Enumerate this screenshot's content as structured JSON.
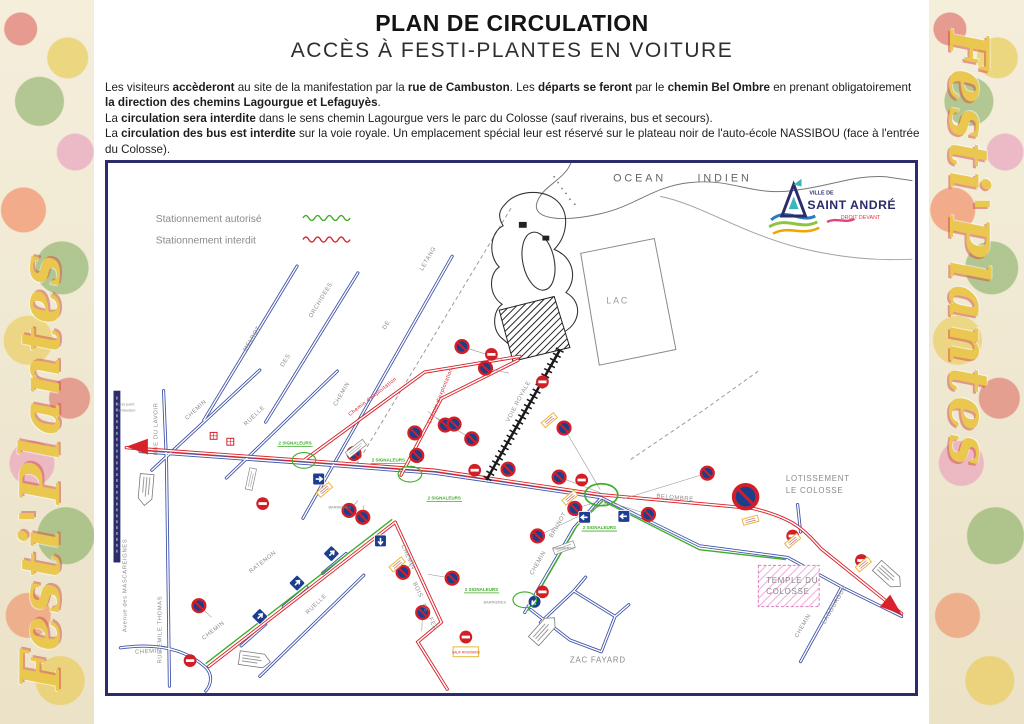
{
  "page": {
    "title_line1": "PLAN DE CIRCULATION",
    "title_line2": "ACCÈS À FESTI-PLANTES EN VOITURE",
    "side_text": "Festi'Plantes"
  },
  "intro": {
    "runs": [
      {
        "t": "Les visiteurs "
      },
      {
        "t": "accèderont",
        "b": 1
      },
      {
        "t": " au site de la manifestation par la "
      },
      {
        "t": "rue de Cambuston",
        "b": 1
      },
      {
        "t": ". Les "
      },
      {
        "t": "départs se feront",
        "b": 1
      },
      {
        "t": " par le "
      },
      {
        "t": "chemin Bel Ombre",
        "b": 1
      },
      {
        "t": " en prenant obligatoirement "
      },
      {
        "t": "la direction des chemins Lagourgue et Lefaguyès",
        "b": 1
      },
      {
        "t": "."
      },
      {
        "t": "La ",
        "br": 1
      },
      {
        "t": "circulation sera interdite",
        "b": 1
      },
      {
        "t": " dans le sens chemin Lagourgue vers le parc du Colosse (sauf riverains, bus et secours)."
      },
      {
        "t": "La ",
        "br": 1
      },
      {
        "t": "circulation des bus est interdite",
        "b": 1
      },
      {
        "t": " sur la voie royale. Un emplacement spécial leur est réservé sur le plateau noir de l'auto-école NASSIBOU (face à l'entrée du Colosse)."
      }
    ]
  },
  "legend": {
    "authorized": "Stationnement autorisé",
    "forbidden": "Stationnement interdit"
  },
  "logo": {
    "ville_de": "VILLE DE",
    "name": "SAINT ANDRÉ",
    "tagline": "DROIT DEVANT"
  },
  "map": {
    "places": {
      "ocean1": "OCEAN",
      "ocean2": "INDIEN",
      "lac": "LAC",
      "rond_point1": "Rond point",
      "rond_point2": "Cambuston",
      "lotissement1": "LOTISSEMENT",
      "lotissement2": "LE COLOSSE",
      "temple1": "TEMPLE DU",
      "temple2": "COLOSSE",
      "zac": "ZAC  FAYARD"
    },
    "streets": {
      "chemin": "CHEMIN",
      "ruelle": "RUELLE",
      "melrot": "MELROT",
      "des": "DES",
      "orchidees": "ORCHIDEES",
      "de": "DE",
      "letang": "LETANG",
      "rue_du_lavoir": "RUE  DU LAVOIR",
      "rue_emile_thomas": "RUE  EMILE  THOMAS",
      "mascareignes": "Avenue des MASCAREIGNES",
      "ratenon": "RATENON",
      "bois": "BOIS",
      "fer": "FER",
      "brunot": "BRUNOT",
      "belombre": "BELOMBRE",
      "lagourgue": "LAGOURGUE",
      "voie_royale": "VOIE   ROYALE",
      "exploitation": "Chemin d'exploitation"
    },
    "notes": {
      "signaleurs": "2 SIGNALEURS",
      "barrieres": "BARRIERES",
      "sauf_riverains": "SAUF RIVERAINS"
    },
    "signs": [
      {
        "type": "np",
        "x": 358,
        "y": 187
      },
      {
        "type": "np",
        "x": 382,
        "y": 209
      },
      {
        "type": "np",
        "x": 341,
        "y": 267
      },
      {
        "type": "np",
        "x": 310,
        "y": 275
      },
      {
        "type": "np",
        "x": 350,
        "y": 266
      },
      {
        "type": "np",
        "x": 368,
        "y": 281
      },
      {
        "type": "np",
        "x": 312,
        "y": 298
      },
      {
        "type": "np",
        "x": 248,
        "y": 296
      },
      {
        "type": "np",
        "x": 243,
        "y": 354
      },
      {
        "type": "np",
        "x": 257,
        "y": 361
      },
      {
        "type": "np",
        "x": 405,
        "y": 312
      },
      {
        "type": "np",
        "x": 462,
        "y": 270
      },
      {
        "type": "np",
        "x": 473,
        "y": 352
      },
      {
        "type": "np",
        "x": 435,
        "y": 380
      },
      {
        "type": "np",
        "x": 457,
        "y": 320
      },
      {
        "type": "np",
        "x": 548,
        "y": 358
      },
      {
        "type": "np",
        "x": 298,
        "y": 417
      },
      {
        "type": "np",
        "x": 348,
        "y": 423
      },
      {
        "type": "np",
        "x": 318,
        "y": 458
      },
      {
        "type": "np",
        "x": 90,
        "y": 451
      },
      {
        "type": "np",
        "x": 608,
        "y": 316
      },
      {
        "type": "ne",
        "x": 371,
        "y": 313
      },
      {
        "type": "ne",
        "x": 480,
        "y": 323
      },
      {
        "type": "ne",
        "x": 695,
        "y": 380
      },
      {
        "type": "ne",
        "x": 765,
        "y": 405
      },
      {
        "type": "ne",
        "x": 440,
        "y": 437
      },
      {
        "type": "ne",
        "x": 362,
        "y": 483
      },
      {
        "type": "ne",
        "x": 81,
        "y": 507
      },
      {
        "type": "ne",
        "x": 155,
        "y": 347
      },
      {
        "type": "ne",
        "x": 388,
        "y": 195
      },
      {
        "type": "ne",
        "x": 440,
        "y": 223
      },
      {
        "type": "bnp",
        "x": 647,
        "y": 340
      },
      {
        "type": "ar",
        "x": 212,
        "y": 322
      },
      {
        "type": "ar",
        "x": 275,
        "y": 385,
        "rot": 90
      },
      {
        "type": "ar",
        "x": 523,
        "y": 360,
        "rot": 180
      },
      {
        "type": "ar",
        "x": 483,
        "y": 361,
        "rot": 180
      },
      {
        "type": "ar",
        "x": 225,
        "y": 398,
        "rot": -45
      },
      {
        "type": "ar",
        "x": 190,
        "y": 428,
        "rot": -45
      },
      {
        "type": "ar",
        "x": 152,
        "y": 462,
        "rot": -45
      },
      {
        "type": "ac",
        "x": 432,
        "y": 447,
        "rot": 135
      },
      {
        "type": "ra",
        "x": 16,
        "y": 289,
        "rot": 180
      },
      {
        "type": "ra",
        "x": 806,
        "y": 460,
        "rot": 40
      },
      {
        "type": "wa",
        "x": 36,
        "y": 332,
        "rot": 95
      },
      {
        "type": "wa",
        "x": 146,
        "y": 506,
        "rot": 8
      },
      {
        "type": "wa",
        "x": 441,
        "y": 476,
        "rot": -48
      },
      {
        "type": "wa",
        "x": 792,
        "y": 420,
        "rot": 42
      },
      {
        "type": "yl",
        "x": 447,
        "y": 262,
        "rot": -40
      },
      {
        "type": "yl",
        "x": 468,
        "y": 341,
        "rot": -40
      },
      {
        "type": "yl",
        "x": 652,
        "y": 364,
        "rot": -15
      },
      {
        "type": "yl",
        "x": 292,
        "y": 409,
        "rot": -40
      },
      {
        "type": "yl",
        "x": 218,
        "y": 333,
        "rot": -40
      },
      {
        "type": "yl",
        "x": 767,
        "y": 409,
        "rot": -40
      },
      {
        "type": "yl",
        "x": 695,
        "y": 385,
        "rot": -40
      },
      {
        "type": "wl",
        "x": 250,
        "y": 291,
        "rot": -38
      },
      {
        "type": "wl",
        "x": 143,
        "y": 322,
        "rot": -78
      },
      {
        "type": "wl",
        "x": 462,
        "y": 392,
        "rot": -20
      },
      {
        "type": "go",
        "x": 197,
        "y": 303
      },
      {
        "type": "go",
        "x": 305,
        "y": 317
      },
      {
        "type": "go",
        "x": 500,
        "y": 338,
        "s": 1.4
      },
      {
        "type": "go",
        "x": 422,
        "y": 445
      },
      {
        "type": "ch",
        "x": 105,
        "y": 278
      },
      {
        "type": "ch",
        "x": 122,
        "y": 284
      }
    ]
  }
}
